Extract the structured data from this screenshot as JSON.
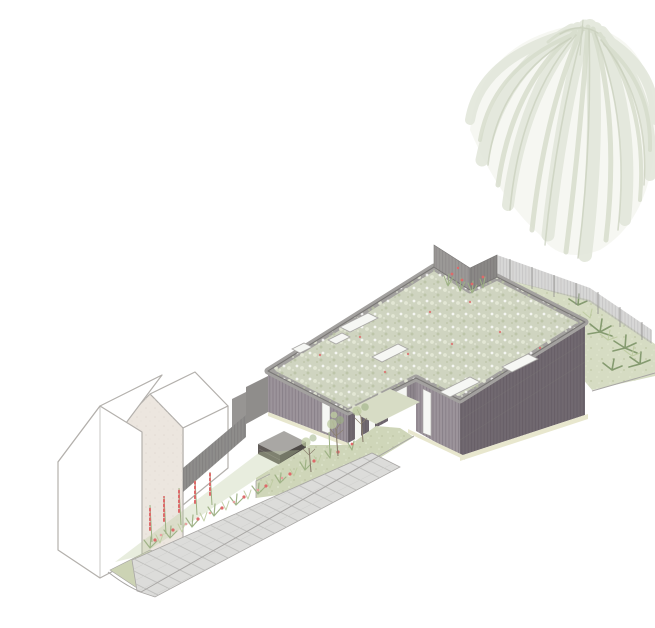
{
  "meta": {
    "description": "Axonometric architectural illustration of a single-storey house with a sedum green roof and vertical timber cladding, approached by a paved garden path with wildflower planting, beside an existing white gabled cottage, with a large weeping willow tree behind",
    "canvas": {
      "width": 655,
      "height": 628
    }
  },
  "colors": {
    "bg": "#ffffff",
    "outline": "#b3b0ac",
    "ground_line": "#a8a6a4",
    "willow_fill": "#eef0e8",
    "willow_light": "#e3e7db",
    "willow_mid": "#d6dccb",
    "willow_fine": "#c6cdb9",
    "roof_green": "#cfd4c0",
    "roof_speck_light": "#e6e9d8",
    "roof_speck_dark": "#b9c2a4",
    "parapet": "#a3a19f",
    "parapet_line": "#7a7876",
    "wall_light": "#9c949b",
    "wall_dark": "#716970",
    "wall_step": "#8d858c",
    "slat_line": "#3d333d",
    "skylight": "#f6f7f4",
    "skylight_stroke": "#a9a7a5",
    "fence_dark": "#8e8d8b",
    "fence_semi": "#b7b6b4",
    "garden_wall": "#8f8d8b",
    "bin_top": "#a9a7a4",
    "bin_front": "#5f5a57",
    "bin_side": "#4e4a47",
    "path": "#dcdcda",
    "path_joint": "#bdbdbb",
    "lawn": "#cfd6b9",
    "courtyard": "#d7dcc5",
    "grass_patch": "#ccd3b4",
    "base_strip": "#e8e7ce",
    "house_white": "#ffffff",
    "house_cream": "#ece6df",
    "foliage": "#9db184",
    "foliage_light": "#bdcba0",
    "planting_dark": "#7d9468",
    "flower_red": "#dd6a6a",
    "flower_pink": "#ea9c9c",
    "tree_trunk": "#8a7f6e"
  },
  "scene": {
    "background": {
      "label": "white page background"
    },
    "willow_tree": {
      "label": "weeping-willow-tree",
      "position": "top-right"
    },
    "new_building": {
      "label": "green-roof-house",
      "roof": "sedum green roof with rooflights",
      "cladding": "vertical timber slats, grey-purple",
      "skylight_count": 6,
      "courtyard": {
        "label": "entrance-courtyard",
        "door_count": 1,
        "window_count": 4,
        "tree_count": 3
      }
    },
    "roof_notch_planting": {
      "label": "planted notch with grasses and red flowers behind parapet"
    },
    "boundary_fence": {
      "label": "timber boundary fence"
    },
    "planted_bank": {
      "label": "planted bank with ferns",
      "position": "right of building"
    },
    "neighbour_house": {
      "label": "white gabled cottage with cream party wall",
      "position": "lower-left"
    },
    "garden_path": {
      "label": "paved path from street to entrance"
    },
    "flower_bed": {
      "label": "wildflower border with red foxgloves"
    },
    "bin_store": {
      "label": "dark timber bin / cycle store"
    },
    "lawn": {
      "label": "front garden lawn"
    }
  }
}
